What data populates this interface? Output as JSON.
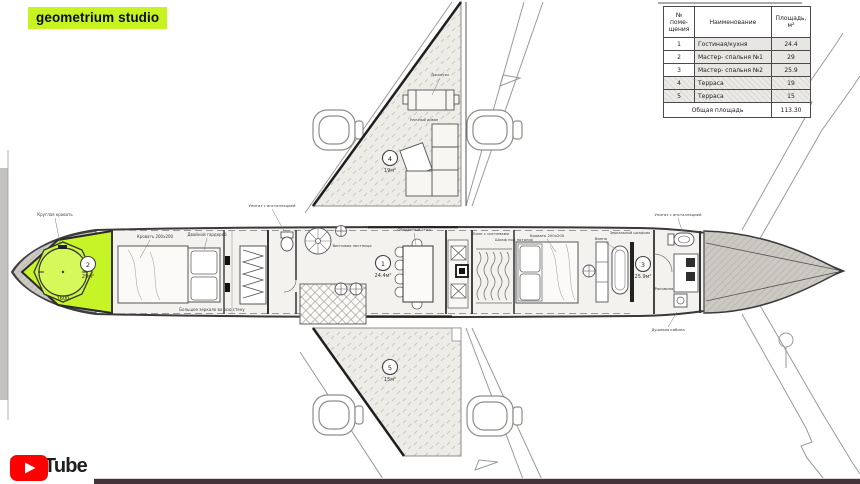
{
  "branding": {
    "studio": "geometrium studio",
    "youtube": "YouTube"
  },
  "colors": {
    "highlight_lime": "#c6f427",
    "logo_bg": "#c7f320",
    "youtube_red": "#ff0000",
    "progress_bar": "#443339",
    "cone_hatch": "#ccc9c3",
    "terrace_fill": "#edece7"
  },
  "table": {
    "header": {
      "num": "№ поме- щения",
      "name": "Наименование",
      "area": "Площадь, м²"
    },
    "rows": [
      {
        "num": "1",
        "name": "Гостиная/кухня",
        "area": "24.4"
      },
      {
        "num": "2",
        "name": "Мастер- спальня №1",
        "area": "29"
      },
      {
        "num": "3",
        "name": "Мастер- спальня №2",
        "area": "25.9"
      },
      {
        "num": "4",
        "name": "Терраса",
        "area": "19"
      },
      {
        "num": "5",
        "name": "Терраса",
        "area": "15"
      }
    ],
    "footer": {
      "label": "Общая площадь",
      "total": "113.30"
    }
  },
  "plan": {
    "rooms": [
      {
        "num": "1",
        "area": "24.4м²"
      },
      {
        "num": "2",
        "area": "29м²"
      },
      {
        "num": "3",
        "area": "25.9м²"
      },
      {
        "num": "4",
        "area": "19м²"
      },
      {
        "num": "5",
        "area": "15м²"
      }
    ],
    "annotations": {
      "nose_bed": "Круглая кровать",
      "bed1": "Кровать 200х200",
      "wardrobe1": "Двойной гардероб",
      "mirror_note": "Большое зеркало во всю стену",
      "wc1": "Унитаз с инсталляцией",
      "stairs": "Винтовая лестница",
      "dining": "Обеденный стол",
      "climate": "Блок с системами",
      "closet2": "Шкаф под потолок",
      "bed2": "Кровать 200х200",
      "bath": "Ванна",
      "mirror_cab": "Зеркальный шкафчик",
      "wc2": "Унитаз с инсталляцией",
      "sink": "Раковина",
      "shower": "Душевая кабина",
      "jacuzzi": "Джакузи",
      "outdoor_sofa": "Уличный диван"
    },
    "dimensions": {
      "round_bed": "1600"
    }
  }
}
